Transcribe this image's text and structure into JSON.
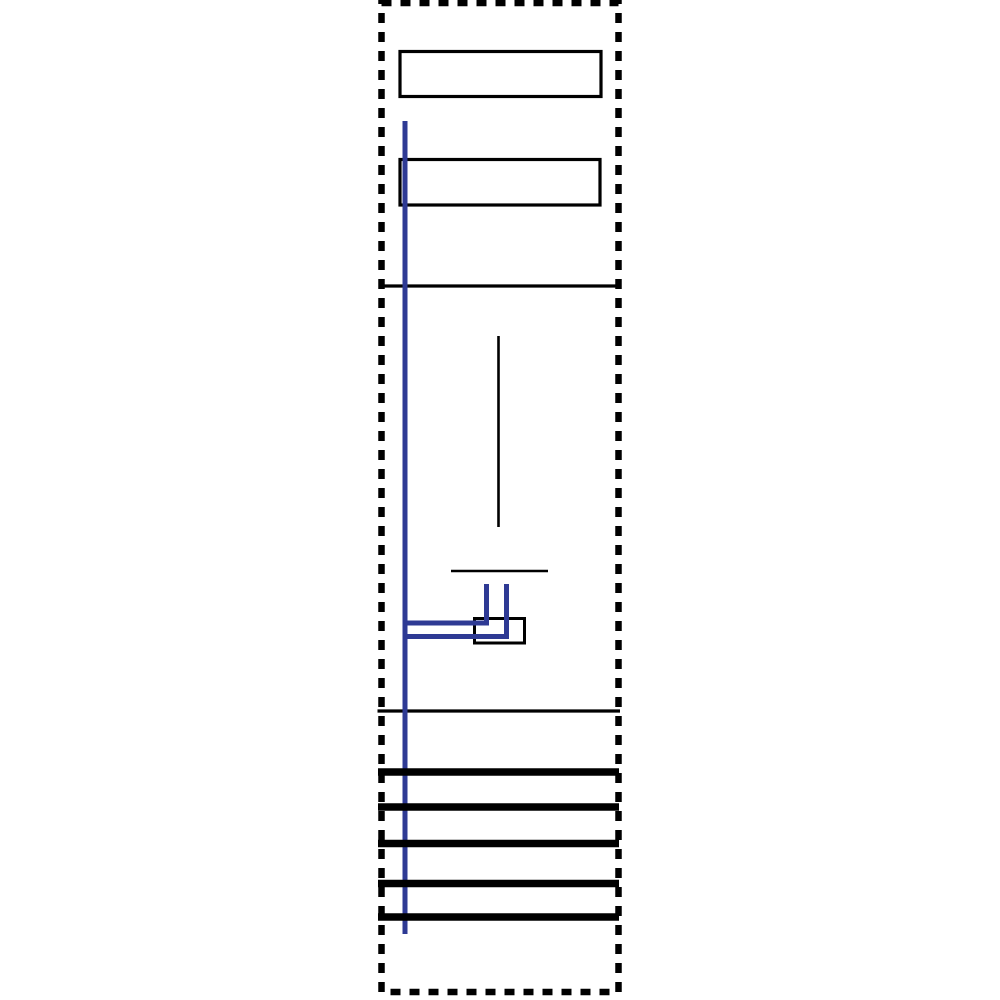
{
  "meta": {
    "description": "Wiring schematic of a single-field meter distribution panel; line drawing only, no visible text"
  },
  "canvas": {
    "width": 1000,
    "height": 1000,
    "viewBox": "0 0 1000 1000",
    "background": "#ffffff"
  },
  "colors": {
    "black": "#000000",
    "blue": "#2e3a94",
    "white": "#ffffff"
  },
  "outline": {
    "x": 381.5,
    "y": 3,
    "width": 237,
    "height": 989,
    "stroke_width": 6.5,
    "dash": "10 9"
  },
  "boxes": [
    {
      "name": "label-box-top",
      "x": 400,
      "y": 51.5,
      "width": 201,
      "height": 45,
      "stroke_width": 3.2
    },
    {
      "name": "label-box-middle",
      "x": 400,
      "y": 159.5,
      "width": 200,
      "height": 45.5,
      "stroke_width": 3.2
    },
    {
      "name": "terminal-box",
      "x": 474.5,
      "y": 618.5,
      "width": 50,
      "height": 24.5,
      "stroke_width": 3
    }
  ],
  "black_lines": [
    {
      "name": "separator-line-top",
      "x1": 380,
      "y1": 286,
      "x2": 618,
      "y2": 286,
      "width": 3.2
    },
    {
      "name": "meter-stem-line",
      "x1": 498.5,
      "y1": 336,
      "x2": 498.5,
      "y2": 527,
      "width": 2.6
    },
    {
      "name": "terminal-strip-line",
      "x1": 451,
      "y1": 571,
      "x2": 548,
      "y2": 571,
      "width": 2.6
    },
    {
      "name": "separator-line-bottom",
      "x1": 377.5,
      "y1": 711,
      "x2": 620,
      "y2": 711,
      "width": 3.2
    }
  ],
  "blue_lines": [
    {
      "name": "main-riser-conductor",
      "x1": 405,
      "y1": 121,
      "x2": 405,
      "y2": 934,
      "width": 5
    },
    {
      "name": "branch-upper-horizontal",
      "x1": 402.5,
      "y1": 623,
      "x2": 489,
      "y2": 623,
      "width": 5
    },
    {
      "name": "branch-lower-horizontal",
      "x1": 402.5,
      "y1": 636.5,
      "x2": 509,
      "y2": 636.5,
      "width": 5
    },
    {
      "name": "branch-left-drop",
      "x1": 486.5,
      "y1": 584,
      "x2": 486.5,
      "y2": 625.5,
      "width": 5
    },
    {
      "name": "branch-right-drop",
      "x1": 506.5,
      "y1": 584,
      "x2": 506.5,
      "y2": 639,
      "width": 5
    }
  ],
  "busbars": {
    "count": 5,
    "x1": 378,
    "x2": 619,
    "stroke_width": 7.5,
    "y_positions": [
      772,
      807,
      843.5,
      883.5,
      917
    ]
  }
}
